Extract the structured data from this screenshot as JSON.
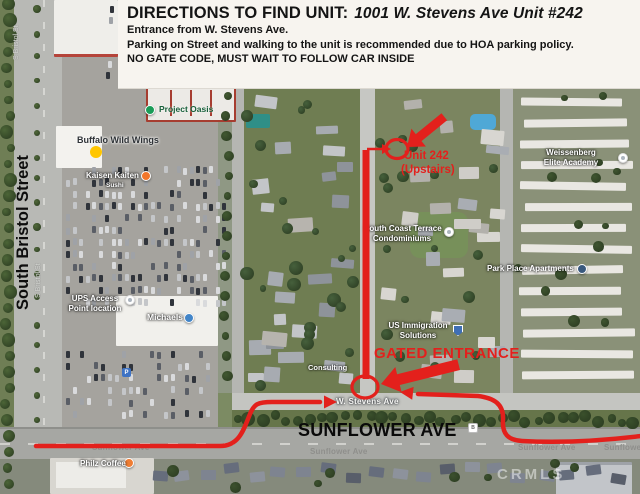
{
  "header": {
    "title_label": "DIRECTIONS TO FIND UNIT:",
    "title_value": "1001 W. Stevens Ave Unit #242",
    "line_entrance": "Entrance from W. Stevens Ave.",
    "line_parking": "Parking on Street and walking to the unit is recommended due to HOA parking policy.",
    "line_gate": "NO GATE CODE, MUST WAIT TO FOLLOW CAR INSIDE"
  },
  "map": {
    "road_labels": {
      "south_bristol_street": "South Bristol Street",
      "s_bristol_st": "S Bristol St",
      "sunflower_ave_big": "SUNFLOWER AVE",
      "sunflower_ave_small": "Sunflower Ave",
      "w_stevens_ave": "W. Stevens Ave"
    },
    "pois": {
      "project_oasis": "Project Oasis",
      "buffalo_wild_wings": "Buffalo Wild Wings",
      "kaisen_1": "Kaisen Kaiten",
      "kaisen_2": "Sushi",
      "ups_access_1": "UPS Access",
      "ups_access_2": "Point location",
      "michaels": "Michaels",
      "south_coast_1": "South Coast Terrace",
      "south_coast_2": "Condominiums",
      "us_immigration_1": "US Immigration",
      "us_immigration_2": "Solutions",
      "weissenberg_1": "Weissenberg",
      "weissenberg_2": "Elite Academy",
      "park_place": "Park Place Apartments",
      "philz": "Philz Coffee",
      "consulting": "Consulting",
      "parking_badge": "P",
      "bus_badge": "B"
    },
    "watermark": "CRMLS"
  },
  "annotations": {
    "red": "#e3201c",
    "unit_line1": "Unit 242",
    "unit_line2": "(Upstairs)",
    "gate": "GATED ENTRANCE"
  }
}
